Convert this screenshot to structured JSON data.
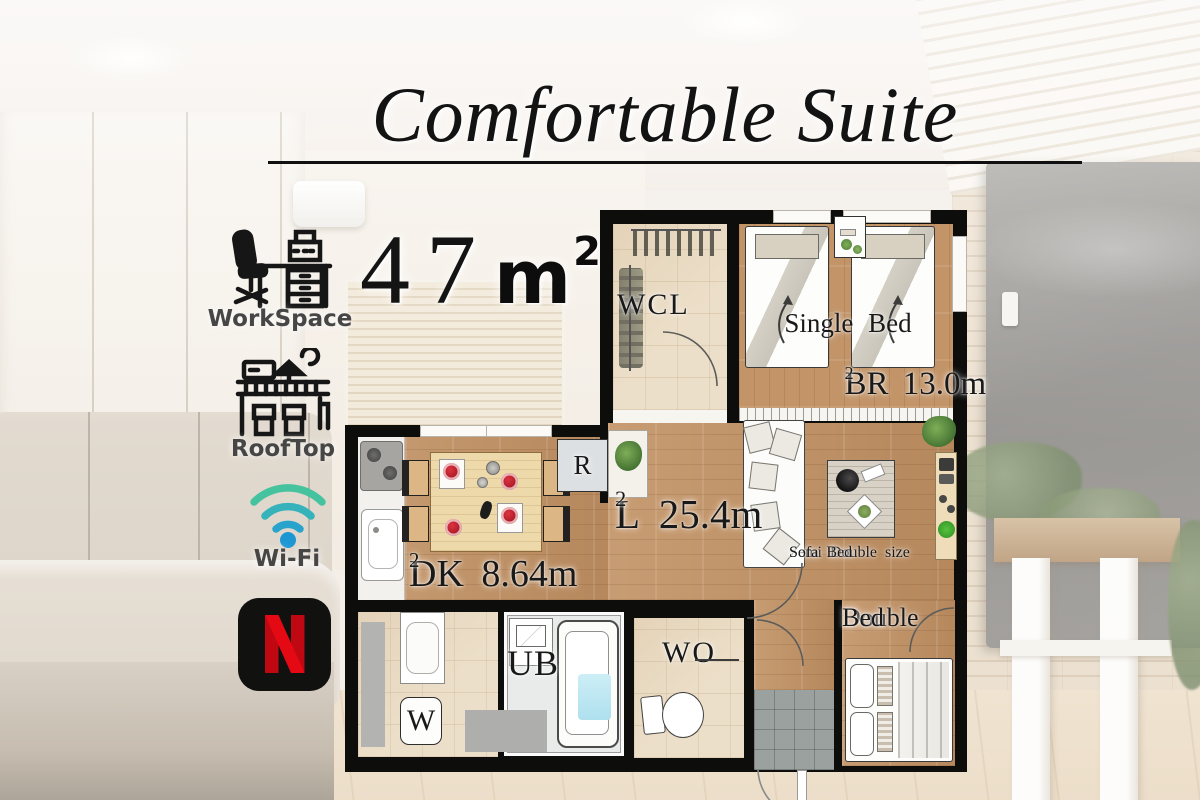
{
  "title": "Comfortable Suite",
  "area": {
    "value": "47",
    "unit_base": "m",
    "unit_exp": "2"
  },
  "amenities": {
    "workspace": {
      "label": "WorkSpace",
      "icon": "workspace-desk-icon"
    },
    "rooftop": {
      "label": "RoofTop",
      "icon": "rooftop-building-icon"
    },
    "wifi": {
      "label": "Wi-Fi",
      "icon": "wifi-icon"
    },
    "netflix": {
      "icon": "netflix-icon"
    }
  },
  "colors": {
    "netflix_red": "#e50914",
    "wifi_green": "#45c29e",
    "wifi_blue": "#1d97d4",
    "wall_black": "#0d0d0c",
    "wood_floor": "#c09164"
  },
  "floorplan": {
    "wcl": {
      "label": "WCL"
    },
    "bedroom": {
      "bed_label": "Single Bed",
      "area_label": "BR 13.0m",
      "area_exp": "2"
    },
    "living": {
      "area_label": "L 25.4m",
      "area_exp": "2",
      "sofa_label_line1": "Semi Double size",
      "sofa_label_line2": "Sofa Bed"
    },
    "dining_kitchen": {
      "area_label": "DK 8.64m",
      "area_exp": "2"
    },
    "refrigerator": {
      "label": "R"
    },
    "unit_bath": {
      "label": "UB"
    },
    "storage": {
      "label": "WO"
    },
    "washer": {
      "label": "W"
    },
    "double_bedroom": {
      "label_line1": "Double",
      "label_line2": "Bed"
    }
  }
}
